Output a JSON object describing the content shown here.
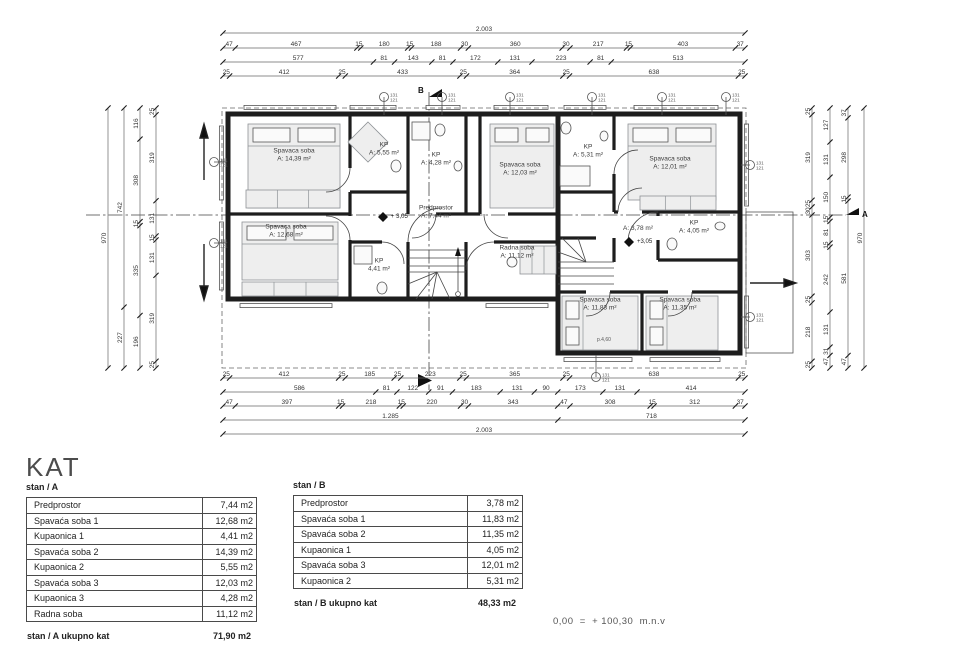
{
  "title": "KAT",
  "note": "0,00  =  + 100,30  m.n.v",
  "plan": {
    "rooms": [
      {
        "name": "Spavaca soba",
        "area": "A: 14,39 m²"
      },
      {
        "name": "KP",
        "area": "A: 5,55 m²"
      },
      {
        "name": "KP",
        "area": "A: 4,28 m²"
      },
      {
        "name": "Spavaca soba",
        "area": "A: 12,03 m²"
      },
      {
        "name": "Spavaca soba",
        "area": "A: 12,68 m²"
      },
      {
        "name": "KP",
        "area": "4,41 m²"
      },
      {
        "name": "Predprostor",
        "area": "A: 7,44 m²"
      },
      {
        "name": "Radna soba",
        "area": "A: 11,12 m²"
      },
      {
        "name": "KP",
        "area": "A: 5,31 m²"
      },
      {
        "name": "Spavaca soba",
        "area": "A: 12,01 m²"
      },
      {
        "name": "",
        "area": "A: 3,78 m²"
      },
      {
        "name": "KP",
        "area": "A: 4,05 m²"
      },
      {
        "name": "Spavaca soba",
        "area": "A: 11,83 m²"
      },
      {
        "name": "Spavaca soba",
        "area": "A: 11,35 m²"
      }
    ],
    "levels": {
      "a": "+ 3,05",
      "b": "+3,05"
    },
    "markers": {
      "section_a": "A",
      "section_b": "B",
      "parapet": "p.4,60"
    },
    "drain_top_label": "131",
    "drain_bottom_label": "121"
  },
  "dims": {
    "h": [
      {
        "y": 33,
        "x1": 223,
        "x2": 745,
        "v": [
          "2.003"
        ]
      },
      {
        "y": 48,
        "x1": 223,
        "x2": 745,
        "v": [
          "47",
          "467",
          "15",
          "180",
          "15",
          "188",
          "30",
          "360",
          "30",
          "217",
          "15",
          "403",
          "37"
        ]
      },
      {
        "y": 62,
        "x1": 223,
        "x2": 745,
        "v": [
          "577",
          "81",
          "143",
          "81",
          "172",
          "131",
          "223",
          "81",
          "513"
        ]
      },
      {
        "y": 76,
        "x1": 223,
        "x2": 745,
        "v": [
          "25",
          "412",
          "25",
          "433",
          "25",
          "364",
          "25",
          "638",
          "25"
        ]
      },
      {
        "y": 378,
        "x1": 223,
        "x2": 745,
        "v": [
          "25",
          "412",
          "25",
          "185",
          "25",
          "223",
          "25",
          "365",
          "25",
          "638",
          "25"
        ]
      },
      {
        "y": 392,
        "x1": 223,
        "x2": 745,
        "v": [
          "586",
          "81",
          "122",
          "91",
          "183",
          "131",
          "90",
          "173",
          "131",
          "414"
        ]
      },
      {
        "y": 406,
        "x1": 223,
        "x2": 745,
        "v": [
          "47",
          "397",
          "15",
          "218",
          "15",
          "220",
          "30",
          "343",
          "47",
          "308",
          "15",
          "312",
          "37"
        ]
      },
      {
        "y": 420,
        "x1": 223,
        "x2": 745,
        "v": [
          "1.285",
          "718"
        ]
      },
      {
        "y": 434,
        "x1": 223,
        "x2": 745,
        "v": [
          "2.003"
        ]
      }
    ],
    "v": [
      {
        "x": 108,
        "y1": 108,
        "y2": 368,
        "v": [
          "970"
        ]
      },
      {
        "x": 124,
        "y1": 108,
        "y2": 368,
        "v": [
          "742",
          "227"
        ]
      },
      {
        "x": 140,
        "y1": 108,
        "y2": 368,
        "v": [
          "116",
          "308",
          "15",
          "335",
          "196"
        ]
      },
      {
        "x": 156,
        "y1": 108,
        "y2": 368,
        "v": [
          "25",
          "319",
          "131",
          "15",
          "131",
          "319",
          "25"
        ]
      },
      {
        "x": 812,
        "y1": 108,
        "y2": 368,
        "v": [
          "25",
          "319",
          "25",
          "30",
          "303",
          "25",
          "218",
          "25"
        ]
      },
      {
        "x": 830,
        "y1": 108,
        "y2": 368,
        "v": [
          "127",
          "131",
          "150",
          "15",
          "81",
          "15",
          "242",
          "131",
          "31",
          "47"
        ]
      },
      {
        "x": 848,
        "y1": 108,
        "y2": 368,
        "v": [
          "37",
          "298",
          "15",
          "581",
          "47"
        ]
      },
      {
        "x": 864,
        "y1": 108,
        "y2": 368,
        "v": [
          "970"
        ]
      }
    ]
  },
  "tables": {
    "a": {
      "header": "stan / A",
      "rows": [
        {
          "name": "Predprostor",
          "value": "7,44 m2"
        },
        {
          "name": "Spavaća soba 1",
          "value": "12,68 m2"
        },
        {
          "name": "Kupaonica 1",
          "value": "4,41 m2"
        },
        {
          "name": "Spavaća soba 2",
          "value": "14,39 m2"
        },
        {
          "name": "Kupaonica 2",
          "value": "5,55 m2"
        },
        {
          "name": "Spavaća soba 3",
          "value": "12,03 m2"
        },
        {
          "name": "Kupaonica 3",
          "value": "4,28 m2"
        },
        {
          "name": "Radna soba",
          "value": "11,12 m2"
        }
      ],
      "total_label": "stan / A  ukupno kat",
      "total_value": "71,90 m2"
    },
    "b": {
      "header": "stan / B",
      "rows": [
        {
          "name": "Predprostor",
          "value": "3,78 m2"
        },
        {
          "name": "Spavaća soba 1",
          "value": "11,83 m2"
        },
        {
          "name": "Spavaća soba 2",
          "value": "11,35 m2"
        },
        {
          "name": "Kupaonica 1",
          "value": "4,05 m2"
        },
        {
          "name": "Spavaća soba 3",
          "value": "12,01 m2"
        },
        {
          "name": "Kupaonica 2",
          "value": "5,31 m2"
        }
      ],
      "total_label": "stan / B  ukupno kat",
      "total_value": "48,33 m2"
    }
  }
}
